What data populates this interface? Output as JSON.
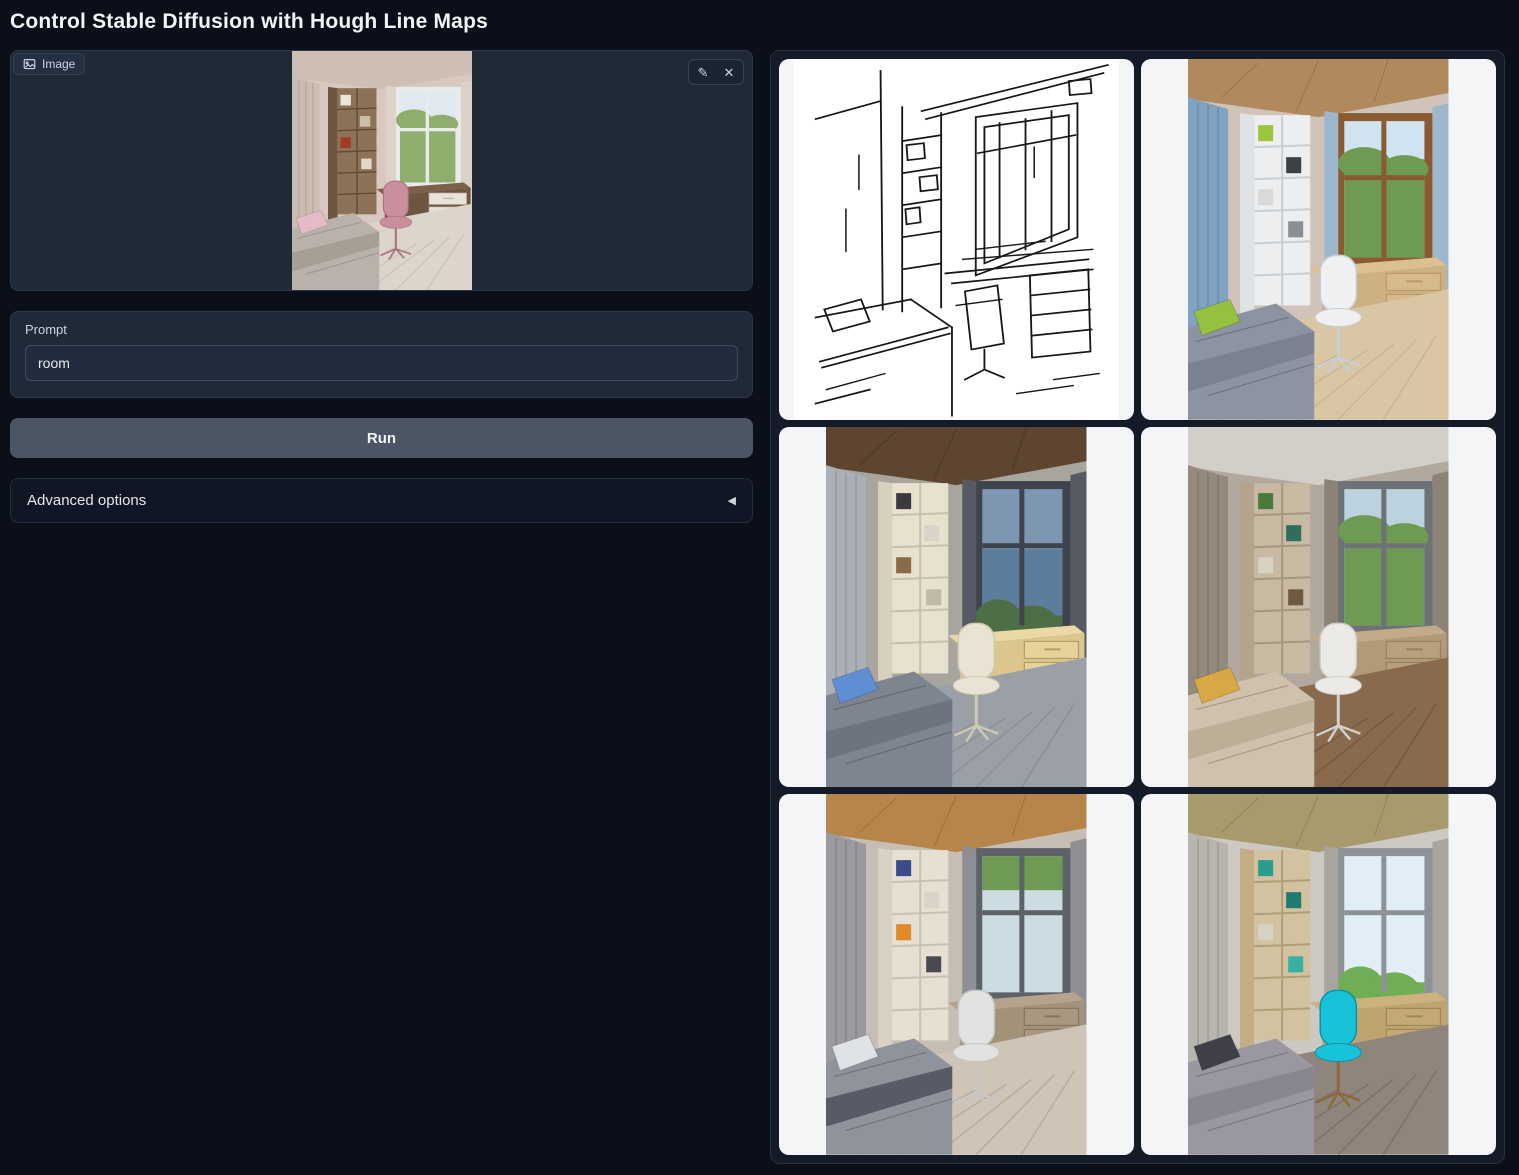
{
  "app": {
    "title": "Control Stable Diffusion with Hough Line Maps"
  },
  "theme": {
    "page_bg": "#0b0f19",
    "panel_bg": "#1f2937",
    "run_button_bg": "#4b5563",
    "gallery_cell_bg": "#f3f5f7",
    "text_primary": "#f3f4f6",
    "text_secondary": "#cbd5e1"
  },
  "image_input": {
    "label": "Image"
  },
  "icons": {
    "edit": "✎",
    "clear": "✕",
    "collapse": "◀"
  },
  "prompt": {
    "label": "Prompt",
    "value": "room"
  },
  "actions": {
    "run_label": "Run"
  },
  "advanced": {
    "label": "Advanced options"
  },
  "gallery": {
    "items": [
      {
        "key": "hough",
        "name": "hough-line-map"
      },
      {
        "key": "r1",
        "name": "generated-room-1"
      },
      {
        "key": "r2",
        "name": "generated-room-2"
      },
      {
        "key": "r3",
        "name": "generated-room-3"
      },
      {
        "key": "r4",
        "name": "generated-room-4"
      },
      {
        "key": "r5",
        "name": "generated-room-5"
      }
    ]
  },
  "scenes": {
    "input": {
      "type": "photo",
      "palette": {
        "wall": "#d8c8c0",
        "ceiling": "#cfbeb4",
        "curtainL": "#cdbcb2",
        "curtainR": "#ddd2c8",
        "shelfSide": "#6e5740",
        "shelf": "#8d7258",
        "shelfLine": "#5f4a36",
        "items": [
          "#e9e5db",
          "#c9bfa6",
          "#a23b28",
          "#e0d8c8"
        ],
        "winFrame": "#e8ebec",
        "sky": "#dfe9ef",
        "trees": "#8fae6e",
        "treesFull": true,
        "deskTop": "#7c6149",
        "deskFront": "#6e5640",
        "drawer": "#e8e2d8",
        "drawerLine": "#c2bab0",
        "chair": "#c98f9c",
        "chairDark": "#a9707e",
        "bed": "#bab2aa",
        "bedDark": "#a79e96",
        "pillow": "#e7bac8",
        "floor": "#dbd5cb",
        "floorLine": "#c8c1b5"
      }
    },
    "hough": {
      "type": "linemap",
      "ink": "#17171b",
      "paper": "#ffffff"
    },
    "r1": {
      "type": "photo",
      "palette": {
        "wall": "#cfc3ba",
        "ceiling": "#b08a5e",
        "ceilingLine": "#97744c",
        "curtainL": "#7fa3c0",
        "curtainR": "#9db8cd",
        "shelfSide": "#dfe3e6",
        "shelf": "#eceeef",
        "shelfLine": "#c9ced3",
        "items": [
          "#9bc53d",
          "#3f3f46",
          "#d9d9d9",
          "#8a8f96"
        ],
        "winFrame": "#8a5a33",
        "sky": "#cfe3f0",
        "trees": "#6f9a54",
        "treesFull": true,
        "deskTop": "#dcc091",
        "deskFront": "#cdb083",
        "drawer": "#d6ba8c",
        "drawerLine": "#b89a6c",
        "chair": "#eef0f2",
        "chairDark": "#c9ced4",
        "bed": "#8c93a1",
        "bedDark": "#7a8292",
        "pillow": "#96c13e",
        "floor": "#d9c6a5",
        "floorLine": "#c9b693"
      }
    },
    "r2": {
      "type": "photo",
      "palette": {
        "wall": "#a8a49e",
        "ceiling": "#5d4530",
        "ceilingLine": "#4a3726",
        "curtainL": "#aab0b6",
        "curtainR": "#565b63",
        "shelfSide": "#d6d0bc",
        "shelf": "#e7e1cd",
        "shelfLine": "#c6c0ac",
        "items": [
          "#3a3a40",
          "#d8d4c8",
          "#8a6a4a",
          "#bfb9a8"
        ],
        "winFrame": "#3f444c",
        "sky": "#7d97b2",
        "skyLower": "#5d7d9d",
        "trees": "#4e6e46",
        "deskTop": "#ead9a4",
        "deskFront": "#dcc68e",
        "drawer": "#e6d39a",
        "drawerLine": "#b49d66",
        "chair": "#e9e3d3",
        "chairDark": "#cfc8b4",
        "bed": "#7e8490",
        "bedDark": "#6d737f",
        "pillow": "#5d8fd2",
        "floor": "#9aa0a6",
        "floorLine": "#8a9096"
      }
    },
    "r3": {
      "type": "photo",
      "palette": {
        "wall": "#b2a99e",
        "ceiling": "#d2cfc9",
        "curtainL": "#958a7e",
        "curtainR": "#8d8276",
        "shelfSide": "#b4a48c",
        "shelf": "#c8b9a2",
        "shelfLine": "#a6967e",
        "items": [
          "#4a7a3a",
          "#2f6e5e",
          "#d8d2c4",
          "#6e5a40"
        ],
        "winFrame": "#6d7276",
        "sky": "#bcd2de",
        "trees": "#6f9a54",
        "treesFull": true,
        "deskTop": "#c3ab8a",
        "deskFront": "#b29a78",
        "drawer": "#b7a07e",
        "drawerLine": "#96805e",
        "chair": "#eceae6",
        "chairDark": "#d2d0ca",
        "bed": "#cfc1ab",
        "bedDark": "#bcae97",
        "pillow": "#d8a844",
        "floor": "#8a6a4c",
        "floorLine": "#77593e"
      }
    },
    "r4": {
      "type": "photo",
      "palette": {
        "wall": "#c6beb4",
        "ceiling": "#b5854a",
        "ceilingLine": "#9a6f3c",
        "curtainL": "#9a9aa0",
        "curtainR": "#8e8e95",
        "shelfSide": "#d9d2c2",
        "shelf": "#e6e0d2",
        "shelfLine": "#c8c1b0",
        "items": [
          "#3a4a8a",
          "#d9d4c8",
          "#e0882a",
          "#4a4a52"
        ],
        "winFrame": "#5d6268",
        "sky": "#cddbe2",
        "treesTop": "#6f9a54",
        "deskTop": "#b4a48e",
        "deskFront": "#a29278",
        "drawer": "#a89880",
        "drawerLine": "#877660",
        "chair": "#e2e2e0",
        "chairDark": "#c6c6c4",
        "bed": "#8e939c",
        "bedDark": "#565b66",
        "pillow": "#dfe2e6",
        "floor": "#cfc5b6",
        "floorLine": "#b8ad9c"
      }
    },
    "r5": {
      "type": "photo",
      "palette": {
        "wall": "#ccc8c2",
        "ceiling": "#a79a6d",
        "ceilingLine": "#8f8358",
        "curtainL": "#b8b4ae",
        "curtainR": "#a8a49e",
        "shelfSide": "#c2ad84",
        "shelf": "#d3c2a0",
        "shelfLine": "#b09e7a",
        "items": [
          "#2a9d8f",
          "#1f7a70",
          "#d8d2c4",
          "#36b0a0"
        ],
        "winFrame": "#8d9298",
        "sky": "#e2eef6",
        "trees": "#6fae54",
        "deskTop": "#cdb27e",
        "deskFront": "#bfa470",
        "drawer": "#c4a876",
        "drawerLine": "#a08852",
        "chair": "#17c3d8",
        "chairDark": "#0c93a8",
        "chairLegs": "#8a6a3c",
        "bed": "#9b97a1",
        "bedDark": "#8a8690",
        "pillow": "#3f3f48",
        "floor": "#8f857c",
        "floorLine": "#7c7269"
      }
    }
  }
}
